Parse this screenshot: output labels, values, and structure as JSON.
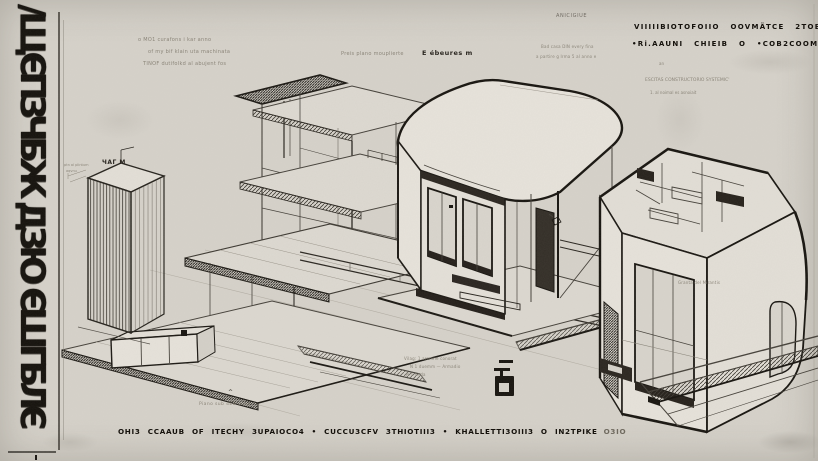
{
  "colors": {
    "paper": "#d6d2ca",
    "ink": "#1b1813",
    "pencil": "#8a8478"
  },
  "left_band": {
    "lettering": "∕ЩЄПЗЧБЖ ДЗЮ ЄШГБЛЄ"
  },
  "annotations": {
    "top_left": [
      "o MO1 curafons i kar anno",
      "of my bif klain uta  machinata",
      "TINOF dutifolkd al abujent fos"
    ],
    "plans_label": "Preis plano mouplierte",
    "e_label": "E ébeures m",
    "mid_right": [
      "Bad casa DIN every fina",
      "a partire g Irma 5 al anno e"
    ],
    "articolo": "ANICIGIUE",
    "tower_label": "ЧАГ М",
    "tower_notes": [
      "ptn al plintum",
      "aqvnu"
    ],
    "granta_label": "Granta del Mirantis",
    "legend": [
      "Vilag: 1 aremne conorat",
      "N 1 duemm — Armadio",
      "N 1 onda"
    ],
    "piano_label": "Piano sub 4EB dove",
    "caret": "^"
  },
  "top_right": {
    "bold": [
      "VIIIIIBIOTOFOIIO OOVMÄTCE 2TOBIOC3OCII",
      "•Ri.AAUNI CHIEIB O •COB2COOMO OHIO"
    ],
    "small": [
      "an",
      "ESCITAS CONSTRUCTORIO SYSTEMIC'",
      "1. al noimal  es asnoiait"
    ]
  },
  "footer": {
    "caption": "OHI3 CCAAUB OF ITECHY 3UPAIOCO4   •   CUCCU3CFV  3THIOTIII3   •   KHALLETTI3OIII3  O IN2TPIKE",
    "tail": "O3IO"
  }
}
